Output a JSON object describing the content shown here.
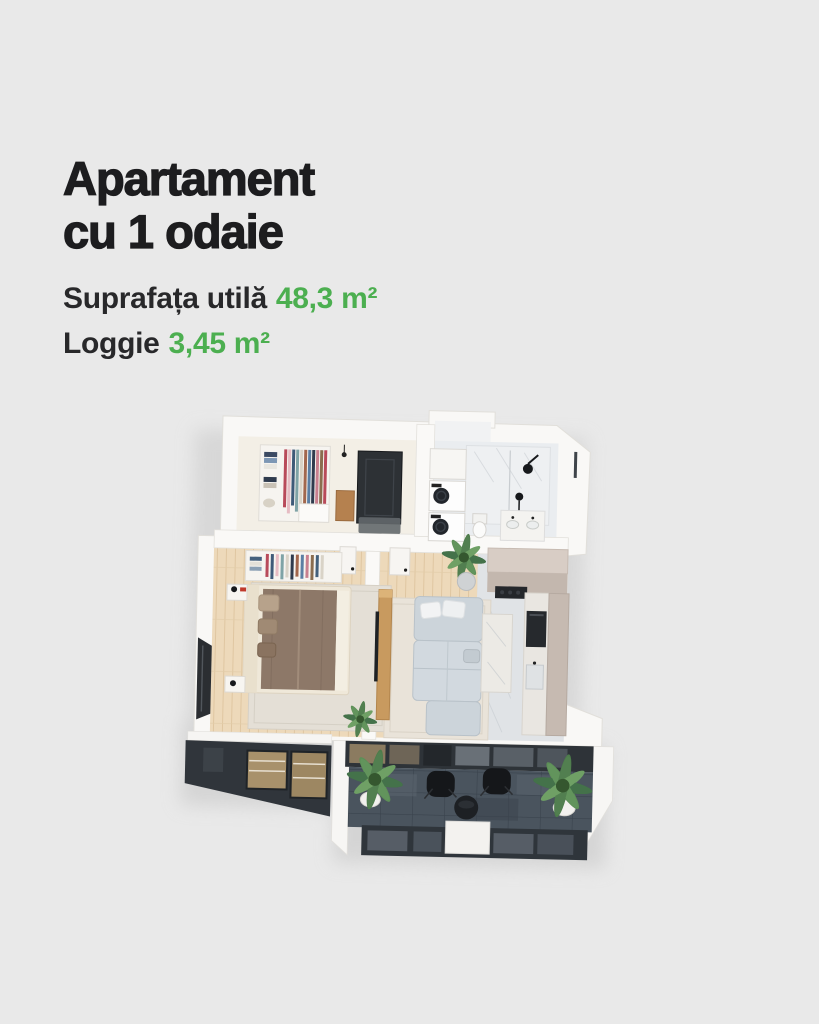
{
  "page": {
    "background": "#e9e9e9"
  },
  "title": {
    "line1": "Apartament",
    "line2": "cu 1 odaie"
  },
  "specs": [
    {
      "label": "Suprafața utilă",
      "value": "48,3 m²"
    },
    {
      "label": "Loggie",
      "value": "3,45 m²"
    }
  ],
  "colors": {
    "heading_text": "#1d1d1f",
    "label_text": "#28282a",
    "value_green": "#4caf50",
    "background": "#e9e9e9",
    "wall_white": "#f9f8f6",
    "wood_floor": "#edd9ba",
    "marble_floor": "#e0e3e6",
    "loggia_slate": "#49525c",
    "facade_dark": "#30353b",
    "sofa_gray": "#ccd4da",
    "bed_brown": "#8d7868",
    "kitchen_greige": "#c6bab1"
  },
  "floorplan": {
    "type": "3d-isometric-render",
    "elements": [
      "entry-hall",
      "wardrobe",
      "entrance-door",
      "doormat",
      "bathroom",
      "washer-dryer-stack",
      "shower",
      "toilet",
      "vanity",
      "bedroom",
      "bed",
      "nightstands",
      "rug",
      "open-shelf",
      "living-room",
      "sofa",
      "coffee-table-island",
      "tv-console",
      "kitchen-counter",
      "cooktop",
      "oven",
      "plants",
      "loggia",
      "lounge-chairs",
      "round-table",
      "glass-facade"
    ]
  }
}
